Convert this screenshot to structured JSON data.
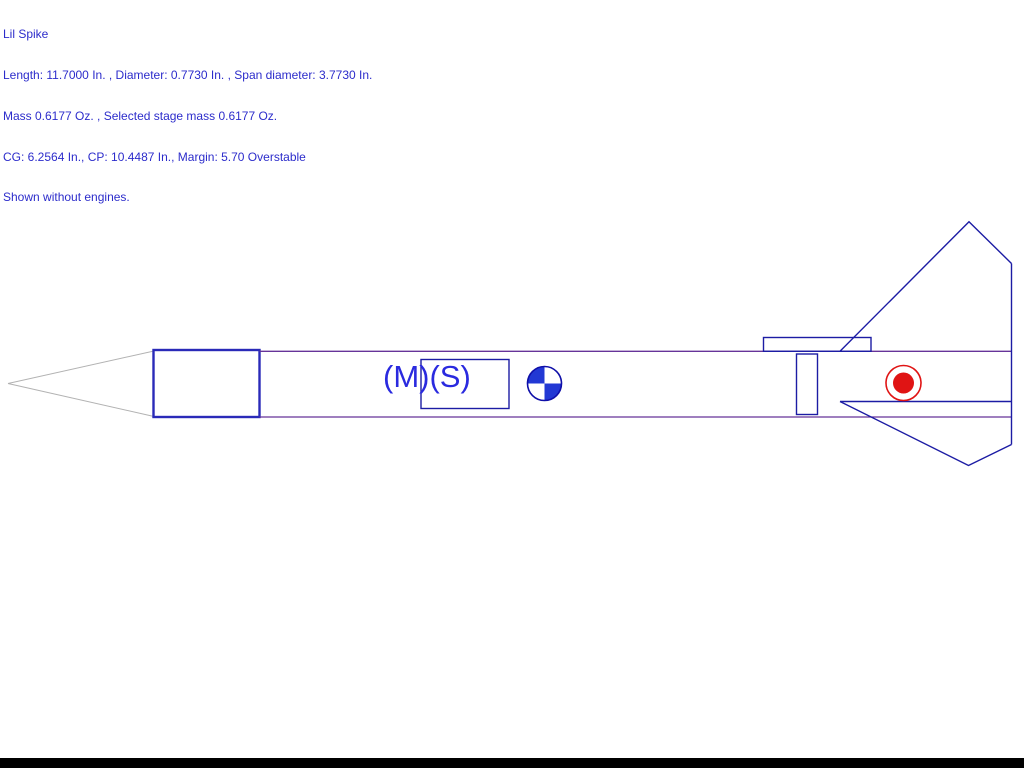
{
  "header": {
    "title": "Lil Spike",
    "line_dimensions": "Length: 11.7000 In. , Diameter: 0.7730 In. , Span diameter: 3.7730 In.",
    "line_mass": "Mass 0.6177 Oz. , Selected stage mass 0.6177 Oz.",
    "line_stability": "CG: 6.2564 In., CP: 10.4487 In., Margin: 5.70 Overstable",
    "line_note": "Shown without engines."
  },
  "stats": {
    "rocket_name": "Lil Spike",
    "length_in": "11.7000",
    "diameter_in": "0.7730",
    "span_diameter_in": "3.7730",
    "mass_oz": "0.6177",
    "selected_stage_mass_oz": "0.6177",
    "cg_in": "6.2564",
    "cp_in": "10.4487",
    "margin": "5.70",
    "stability_text": "Overstable",
    "engines_note": "Shown without engines."
  },
  "drawing": {
    "mass_label": "(M)(S)",
    "cg_marker": "center-of-gravity",
    "cp_marker": "center-of-pressure"
  },
  "colors": {
    "canvas_bg": "#FFFFFF",
    "header_text": "#2C2CCB",
    "nose_gray": "#B2B2B2",
    "nose_block": "#2A2AB8",
    "body_tube": "#663399",
    "component": "#1C1CA4",
    "mass_label": "#2A2ADF",
    "cg_outline": "#0F0FA8",
    "cg_fill": "#2238D4",
    "cp_red": "#E01414",
    "bottom_bar": "#000000"
  }
}
